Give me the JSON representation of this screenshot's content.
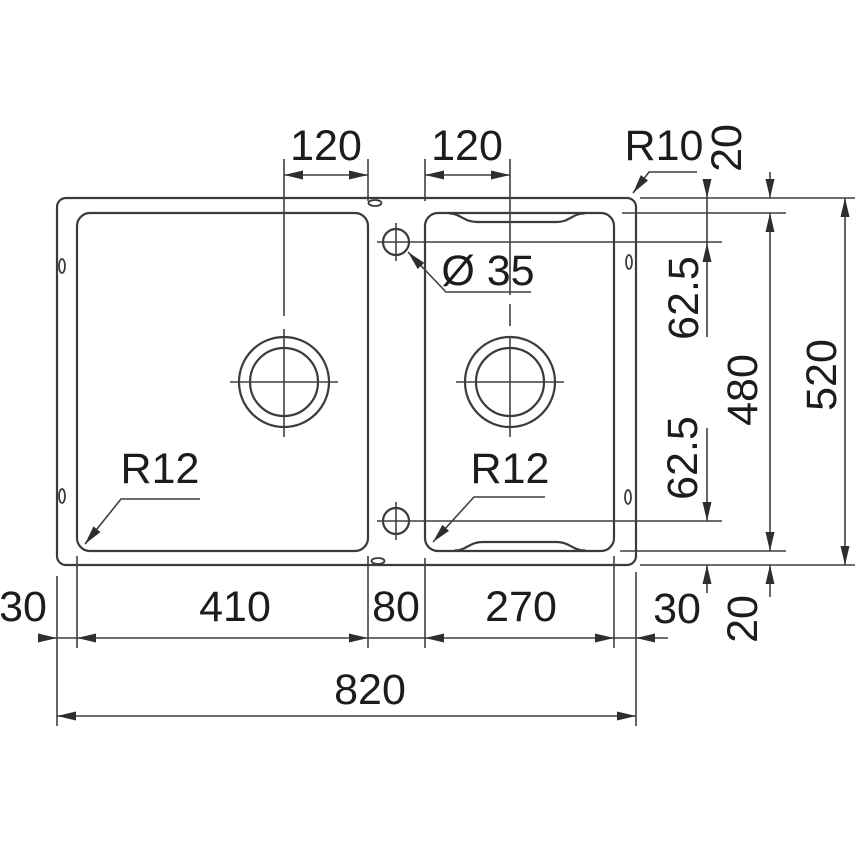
{
  "drawing": {
    "type": "sink-installation-dimension-diagram",
    "units_implied": "mm",
    "labels": {
      "top_left_offset": "120",
      "top_right_offset": "120",
      "corner_radius": "R10",
      "rim_top": "20",
      "faucet_hole_diameter": "Ø 35",
      "faucet_top_offset": "62.5",
      "faucet_bottom_offset": "62.5",
      "inner_depth": "480",
      "overall_depth": "520",
      "bowl_left_radius": "R12",
      "bowl_right_radius": "R12",
      "margin_left": "30",
      "bowl_left_width": "410",
      "divider_width": "80",
      "bowl_right_width": "270",
      "margin_right": "30",
      "rim_bottom": "20",
      "overall_width": "820"
    },
    "colors": {
      "line": "#3b3b3b",
      "dimension_line": "#3f3f3f",
      "text": "#1c1c1c",
      "background": "#ffffff"
    }
  }
}
